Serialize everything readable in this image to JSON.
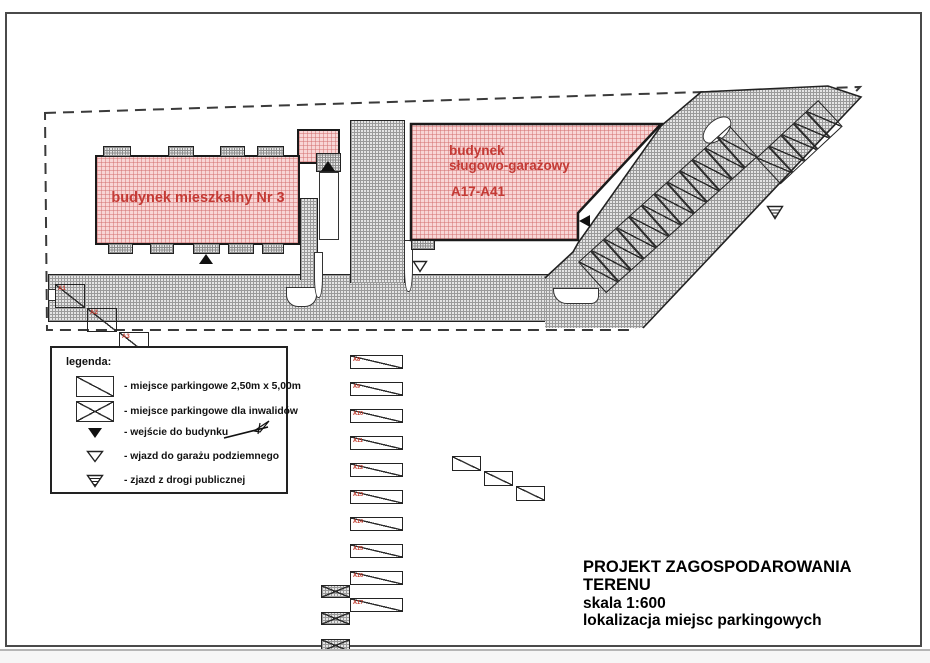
{
  "buildings": {
    "residential": {
      "label": "budynek mieszkalny Nr 3"
    },
    "garage": {
      "name_line1": "budynek",
      "name_line2": "sługowo-garażowy",
      "range": "A17-A41"
    }
  },
  "parking": {
    "bottom_row": [
      "A1",
      "A2",
      "A3",
      "A4",
      "A5",
      "A6",
      "A7"
    ],
    "middle_column": [
      "A8",
      "A9",
      "A10",
      "A11",
      "A12",
      "A13",
      "A14",
      "A15",
      "A16",
      "A17"
    ]
  },
  "legend": {
    "title": "legenda:",
    "items": [
      {
        "symbol": "parking-space-icon",
        "label": "- miejsce parkingowe 2,50m x 5,00m"
      },
      {
        "symbol": "disabled-parking-icon",
        "label": "- miejsce parkingowe dla inwalidów"
      },
      {
        "symbol": "building-entrance-icon",
        "label": "- wejście do budynku"
      },
      {
        "symbol": "underground-garage-entrance-icon",
        "label": "- wjazd do garażu podziemnego"
      },
      {
        "symbol": "public-road-exit-icon",
        "label": "- zjazd z drogi publicznej"
      }
    ]
  },
  "title_block": {
    "line1": "PROJEKT ZAGOSPODAROWANIA TERENU",
    "line2": "skala 1:600",
    "line3": "lokalizacja miejsc parkingowych"
  },
  "colors": {
    "building_fill": "#f8d6d6",
    "road_fill": "#e4e4e4",
    "accent_red": "#c43a35",
    "line": "#222222"
  }
}
